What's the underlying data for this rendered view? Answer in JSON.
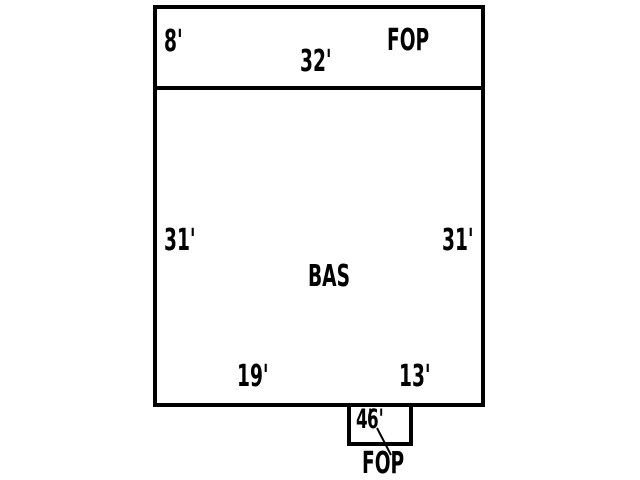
{
  "sketch": {
    "colors": {
      "line": "#000000",
      "text": "#000000",
      "background": "#ffffff"
    },
    "top_area": {
      "name": "FOP",
      "left_dim": "8'",
      "width_dim": "32'"
    },
    "main_area": {
      "name": "BAS",
      "left_dim": "31'",
      "right_dim": "31'",
      "bottom_left_dim": "19'",
      "bottom_right_dim": "13'"
    },
    "bottom_area": {
      "name": "FOP",
      "height_dim": "4'",
      "width_dim": "6'"
    }
  }
}
